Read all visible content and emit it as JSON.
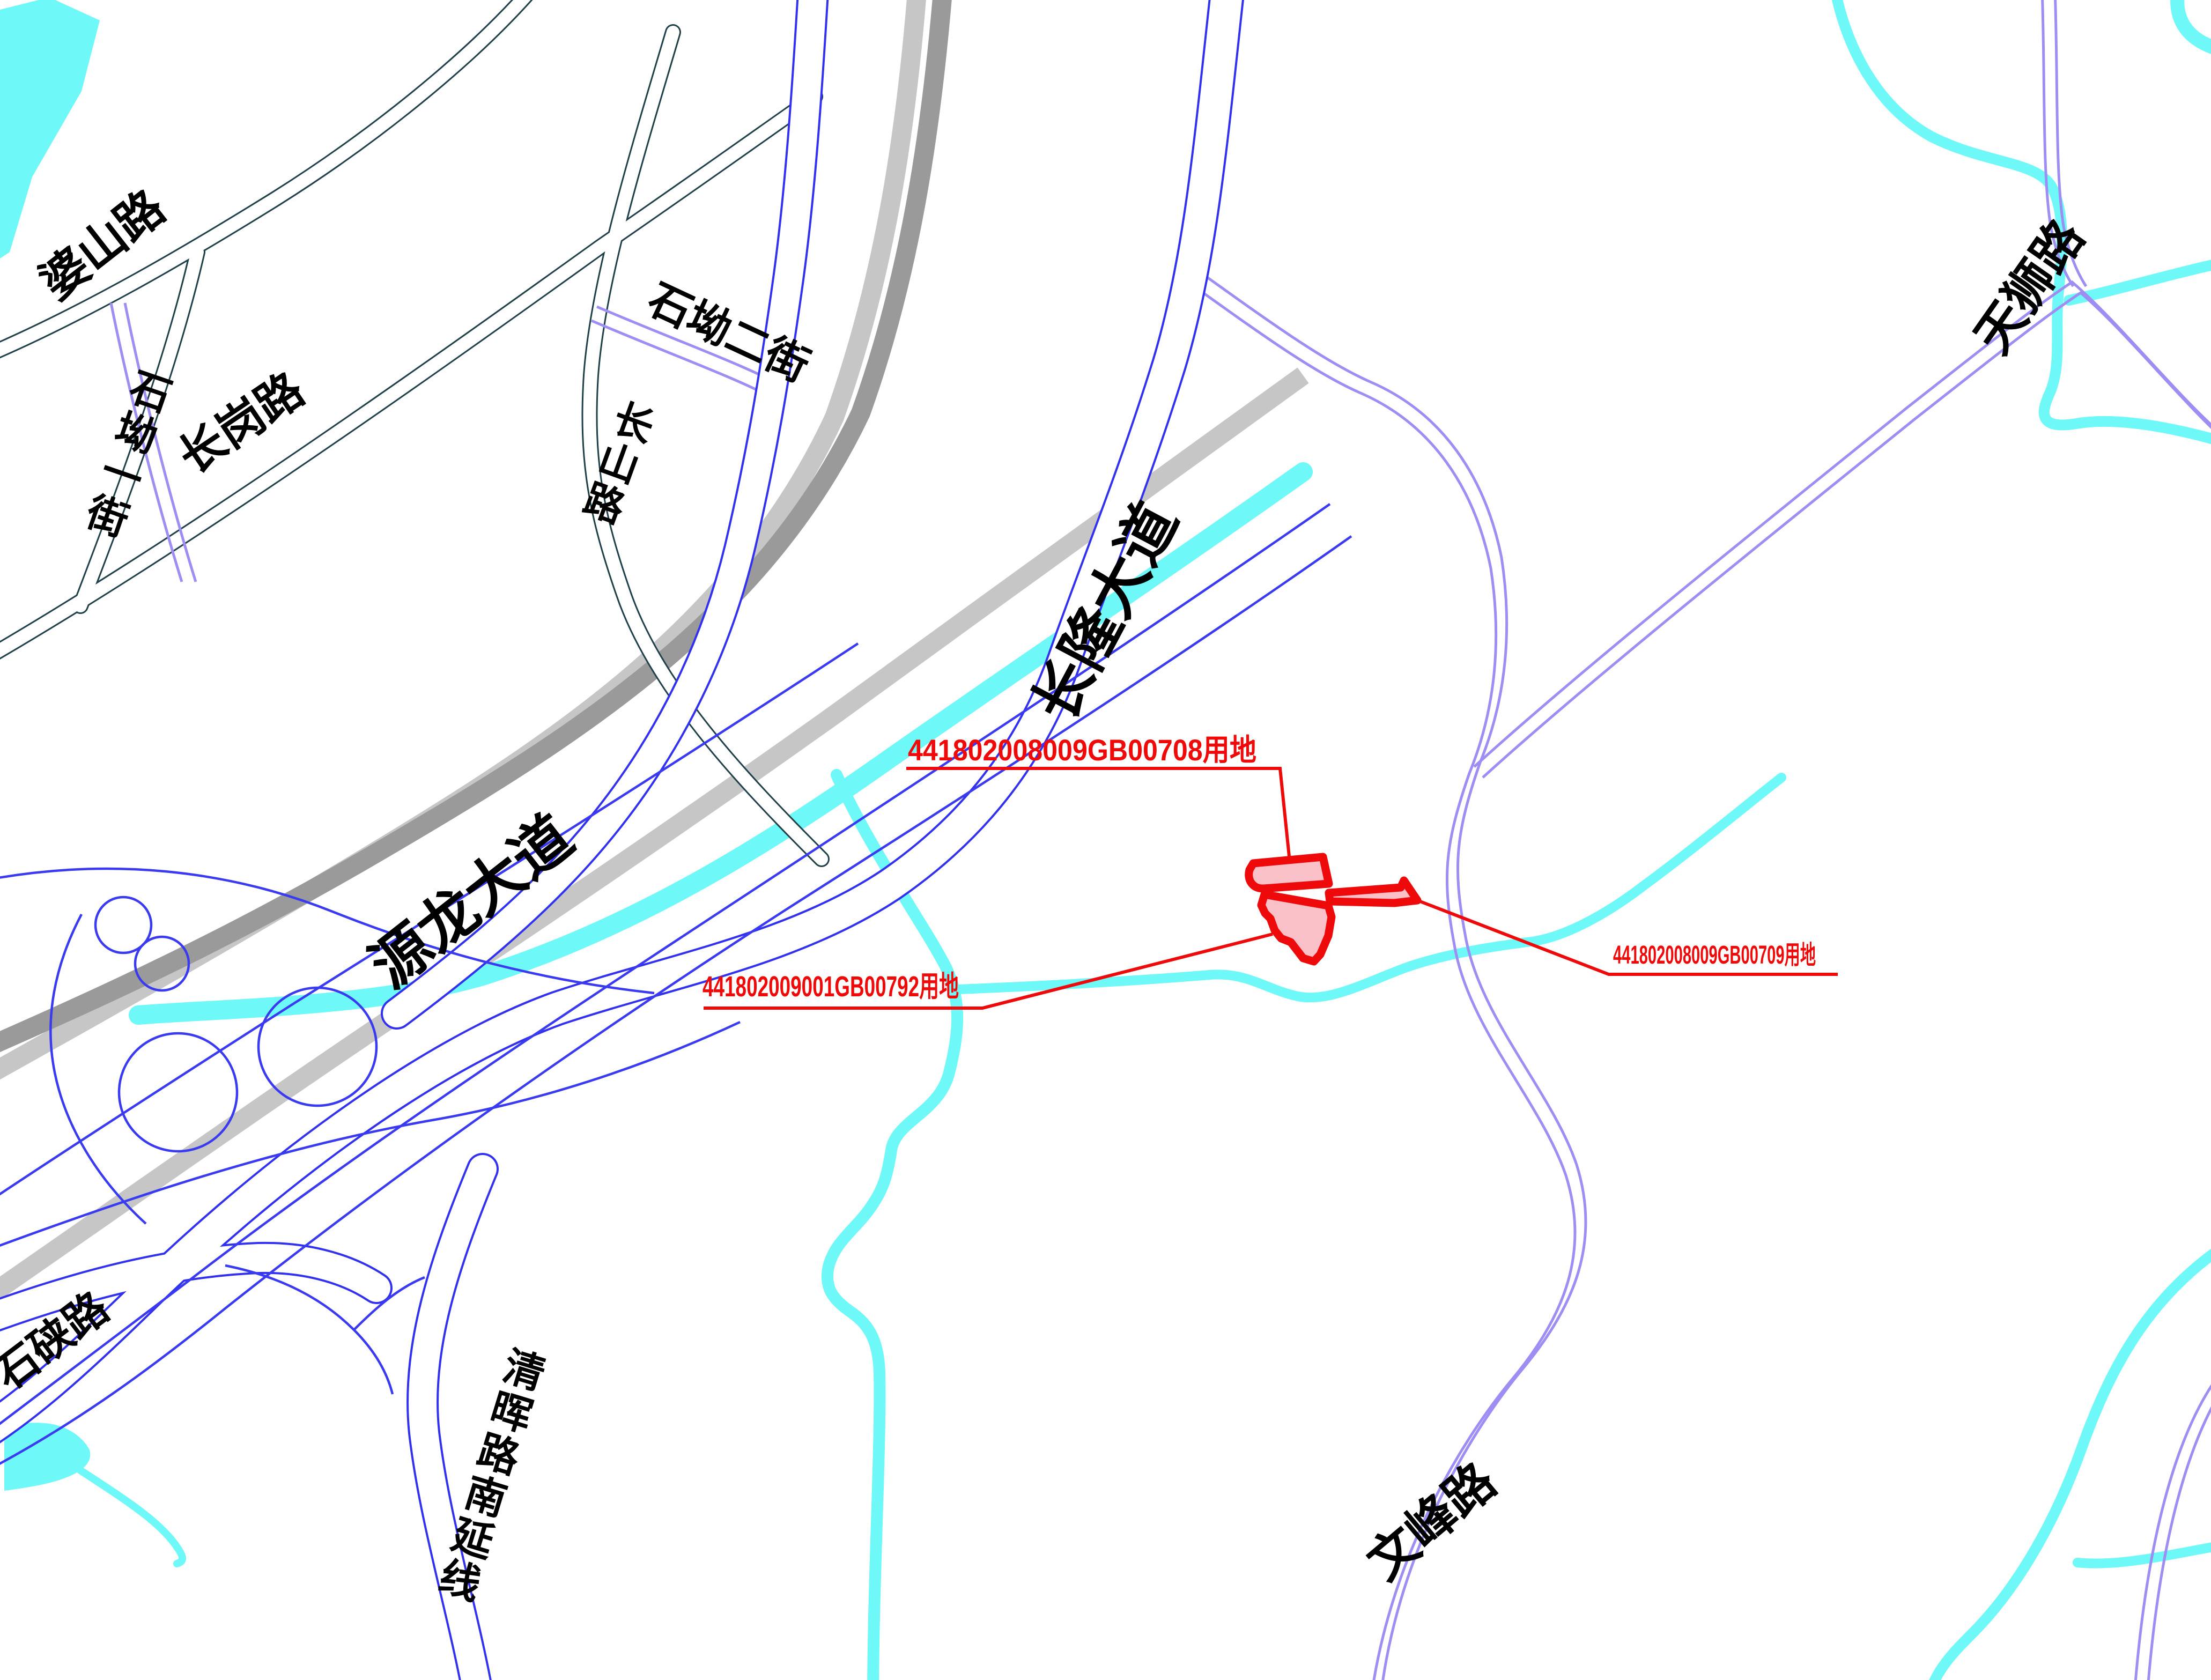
{
  "map_type": "parcel-location-cad-map",
  "roads": {
    "poshan": {
      "label": "婆山路"
    },
    "shiaoyijie": {
      "label": "石坳一街"
    },
    "changgang": {
      "label": "长岗路"
    },
    "shiaoerjie": {
      "label": "石坳二街"
    },
    "changshan": {
      "label": "长山路"
    },
    "changlong": {
      "label": "长隆大道"
    },
    "yuanlong": {
      "label": "源龙大道"
    },
    "shixia": {
      "label": "石硖路"
    },
    "qinghui": {
      "label": "清晖路南延线"
    },
    "wenfeng": {
      "label": "文峰路"
    },
    "tianshi": {
      "label": "天狮路"
    }
  },
  "parcels": {
    "p708": {
      "label": "441802008009GB00708用地"
    },
    "p792": {
      "label": "441802009001GB00792用地"
    },
    "p709": {
      "label": "441802008009GB00709用地"
    }
  },
  "colors": {
    "parcel_fill": "#f9c0c8",
    "parcel_stroke": "#ee0a0a",
    "road_blue": "#3232ee",
    "road_purple": "#9e8df2",
    "road_teal": "#1f4048",
    "expressway_dark": "#9a9a9a",
    "expressway_light": "#c6c6c6",
    "water": "#6ef8f8",
    "label_black": "#000000",
    "label_red": "#f00909"
  }
}
